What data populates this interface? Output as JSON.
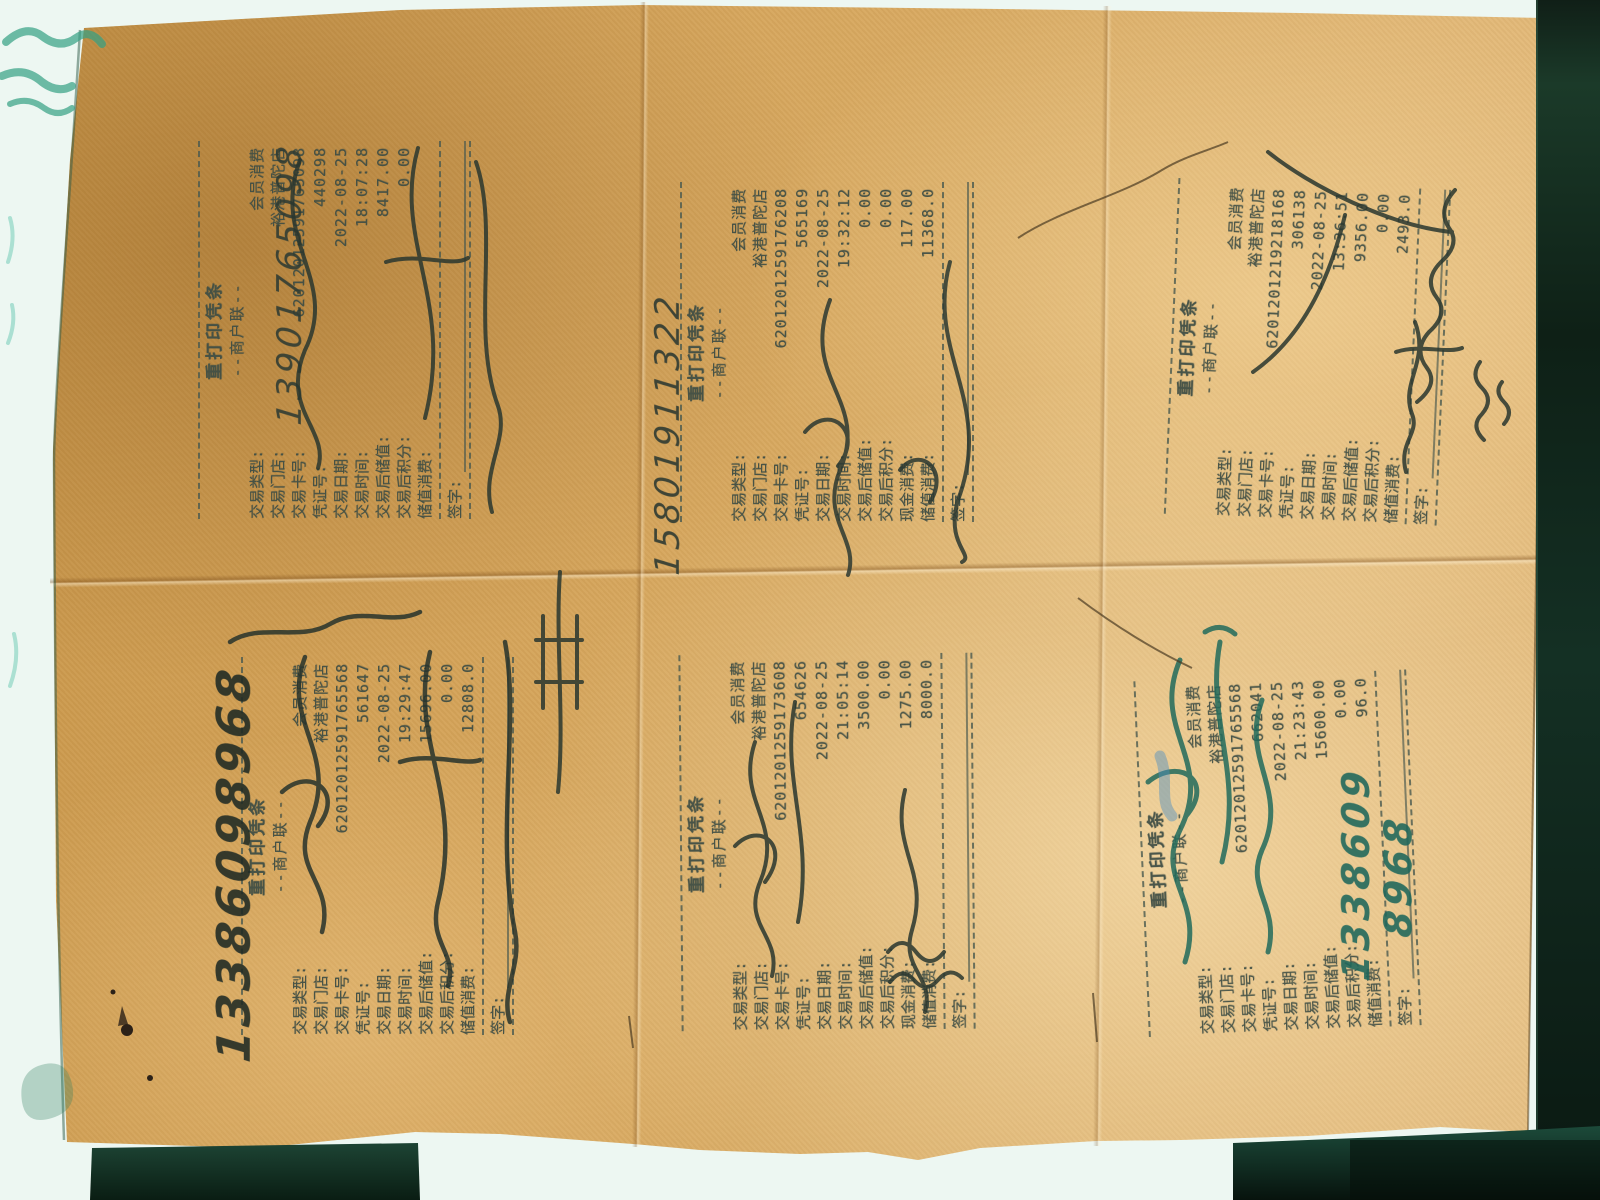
{
  "scene": "photograph of a folded kraft-paper sheet with six reprinted POS voucher stamps, handwritten phone numbers and signatures",
  "colors": {
    "paper": "#d6a75f",
    "print_ink": "#3f4e45",
    "pen_dark": "#2a372f",
    "pen_teal": "#1f6e60",
    "pen_blue": "#4d8fc2",
    "scanner_background": "#edf7f2",
    "dark_edge": "#0e2016"
  },
  "receipts": [
    {
      "title": "重打印凭条",
      "copy_line": "--商户联--",
      "rows": [
        [
          "交易类型:",
          "会员消费"
        ],
        [
          "交易门店:",
          "裕港普陀店"
        ],
        [
          "交易卡号:",
          "62012012591765098"
        ],
        [
          "凭证号:",
          "440298"
        ],
        [
          "交易日期:",
          "2022-08-25"
        ],
        [
          "交易时间:",
          "18:07:28"
        ],
        [
          "交易后储值:",
          "8417.00"
        ],
        [
          "交易后积分:",
          "0.00"
        ],
        [
          "储值消费:",
          ""
        ]
      ],
      "sign_label": "签字:",
      "handwriting": {
        "phone": "13901765098"
      }
    },
    {
      "title": "重打印凭条",
      "copy_line": "--商户联--",
      "rows": [
        [
          "交易类型:",
          "会员消费"
        ],
        [
          "交易门店:",
          "裕港普陀店"
        ],
        [
          "交易卡号:",
          "6201201259176208"
        ],
        [
          "凭证号:",
          "565169"
        ],
        [
          "交易日期:",
          "2022-08-25"
        ],
        [
          "交易时间:",
          "19:32:12"
        ],
        [
          "交易后储值:",
          "0.00"
        ],
        [
          "交易后积分:",
          "0.00"
        ],
        [
          "现金消费:",
          "117.00"
        ],
        [
          "储值消费:",
          "11368.0"
        ]
      ],
      "sign_label": "签字:",
      "handwriting": {
        "phone": "15801911322"
      }
    },
    {
      "title": "重打印凭条",
      "copy_line": "--商户联--",
      "rows": [
        [
          "交易类型:",
          "会员消费"
        ],
        [
          "交易门店:",
          "裕港普陀店"
        ],
        [
          "交易卡号:",
          "6201201219218168"
        ],
        [
          "凭证号:",
          "306138"
        ],
        [
          "交易日期:",
          "2022-08-25"
        ],
        [
          "交易时间:",
          "13:36:51"
        ],
        [
          "交易后储值:",
          "9356.00"
        ],
        [
          "交易后积分:",
          "0.00"
        ],
        [
          "储值消费:",
          "2493.0"
        ]
      ],
      "sign_label": "签字:",
      "handwriting": {}
    },
    {
      "title": "重打印凭条",
      "copy_line": "--商户联--",
      "rows": [
        [
          "交易类型:",
          "会员消费"
        ],
        [
          "交易门店:",
          "裕港普陀店"
        ],
        [
          "交易卡号:",
          "62012012591765568"
        ],
        [
          "凭证号:",
          "561647"
        ],
        [
          "交易日期:",
          "2022-08-25"
        ],
        [
          "交易时间:",
          "19:29:47"
        ],
        [
          "交易后储值:",
          "15696.00"
        ],
        [
          "交易后积分:",
          "0.00"
        ],
        [
          "储值消费:",
          "12808.0"
        ]
      ],
      "sign_label": "签字:",
      "handwriting": {
        "phone": "13386098968"
      }
    },
    {
      "title": "重打印凭条",
      "copy_line": "--商户联--",
      "rows": [
        [
          "交易类型:",
          "会员消费"
        ],
        [
          "交易门店:",
          "裕港普陀店"
        ],
        [
          "交易卡号:",
          "6201201259173608"
        ],
        [
          "凭证号:",
          "654626"
        ],
        [
          "交易日期:",
          "2022-08-25"
        ],
        [
          "交易时间:",
          "21:05:14"
        ],
        [
          "交易后储值:",
          "3500.00"
        ],
        [
          "交易后积分:",
          "0.00"
        ],
        [
          "现金消费:",
          "1275.00"
        ],
        [
          "储值消费:",
          "8000.0"
        ]
      ],
      "sign_label": "签字:",
      "handwriting": {}
    },
    {
      "title": "重打印凭条",
      "copy_line": "--商户联--",
      "rows": [
        [
          "交易类型:",
          "会员消费"
        ],
        [
          "交易门店:",
          "裕港普陀店"
        ],
        [
          "交易卡号:",
          "62012012591765568"
        ],
        [
          "凭证号:",
          "662041"
        ],
        [
          "交易日期:",
          "2022-08-25"
        ],
        [
          "交易时间:",
          "21:23:43"
        ],
        [
          "交易后储值:",
          "15600.00"
        ],
        [
          "交易后积分:",
          "0.00"
        ],
        [
          "储值消费:",
          "96.0"
        ]
      ],
      "sign_label": "签字:",
      "handwriting": {
        "phone": "13386098968",
        "phone_lines": [
          "1338609",
          "8968"
        ]
      }
    }
  ]
}
